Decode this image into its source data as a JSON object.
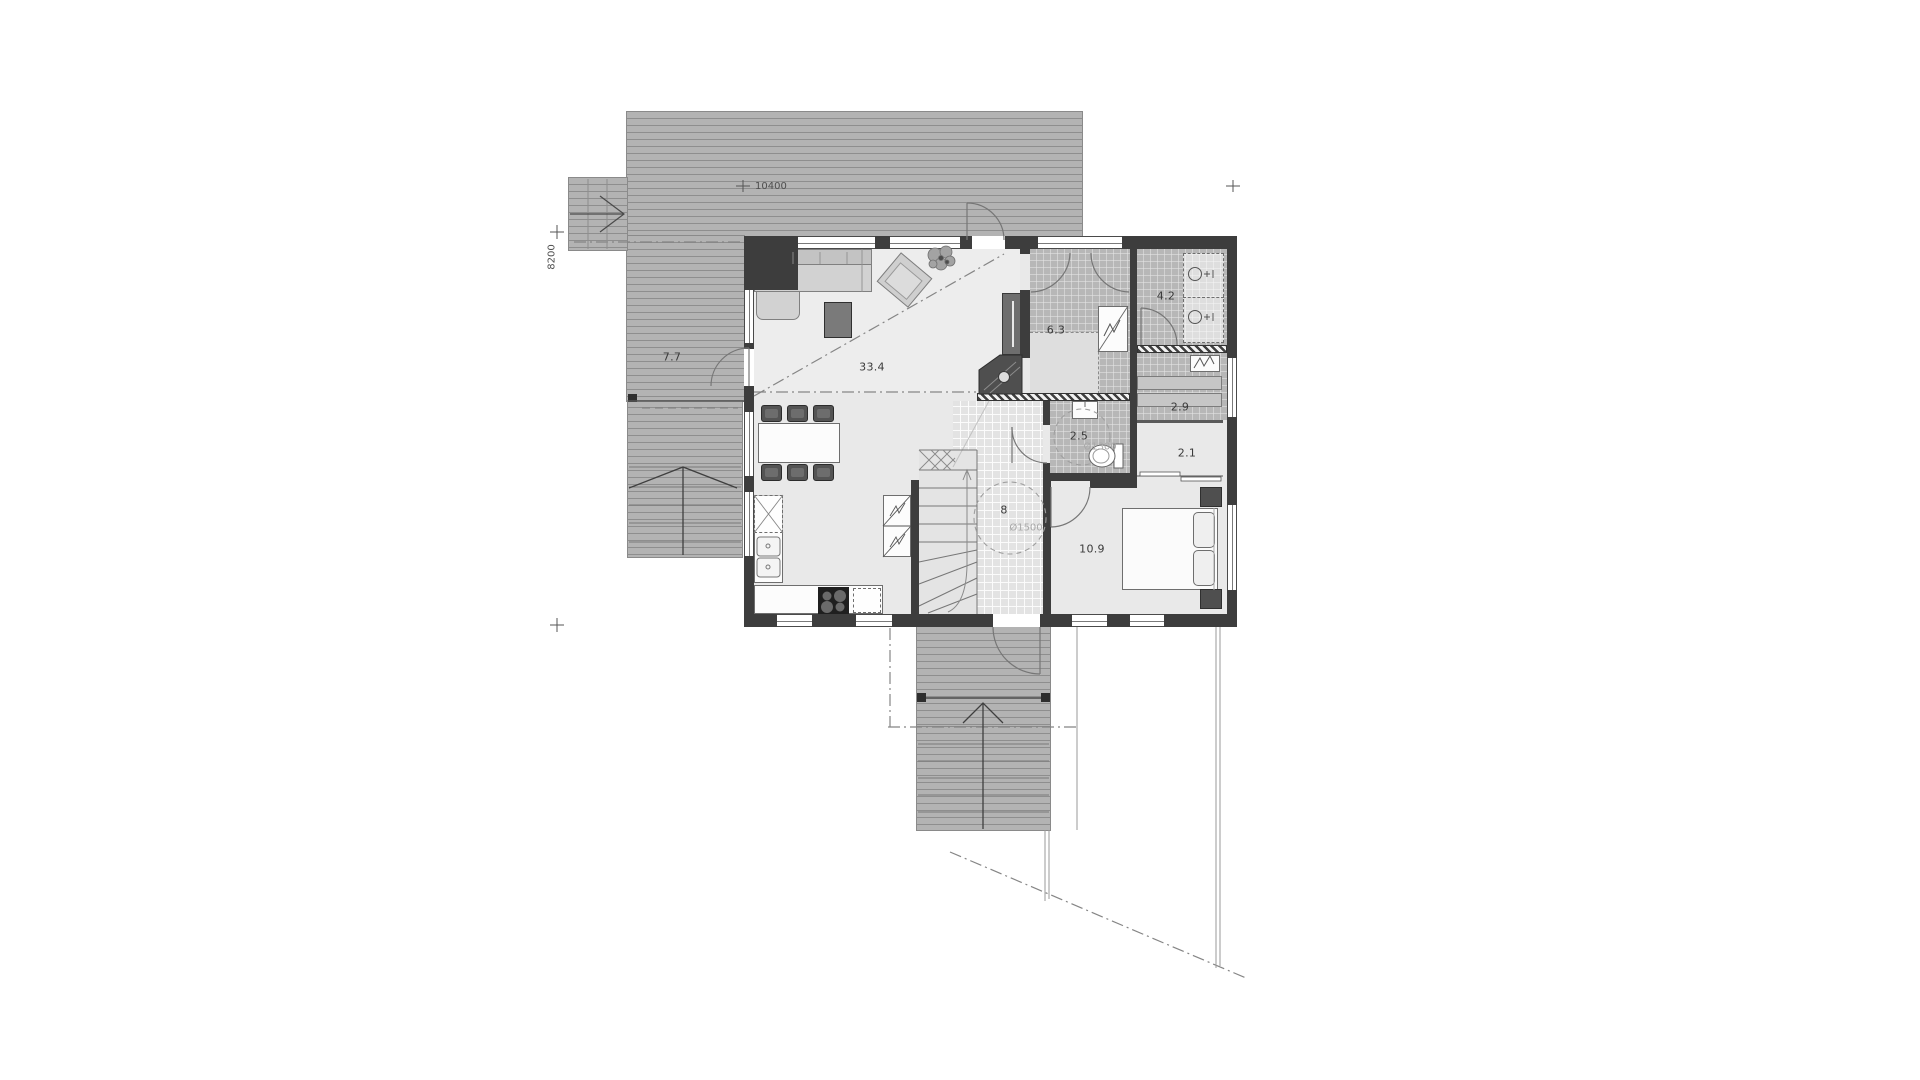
{
  "plan_title": "floor-plan",
  "dimensions": {
    "top": "10400",
    "left": "8200"
  },
  "rooms": {
    "terrace": {
      "area": "7.7"
    },
    "living": {
      "area": "33.4"
    },
    "bathroom": {
      "area": "6.3"
    },
    "utility": {
      "area": "4.2"
    },
    "techroom": {
      "area": "2.9"
    },
    "wc": {
      "area": "2.5"
    },
    "closet": {
      "area": "2.1"
    },
    "hall": {
      "area": "8"
    },
    "bedroom": {
      "area": "10.9"
    }
  },
  "annotations": {
    "hall_turning_circle": "Ø1500",
    "wc_turning_circle": "Ø1300"
  },
  "colors": {
    "deck": "#b3b3b3",
    "floor": "#e9e9e9",
    "tile": "#b7b7b7",
    "wall": "#3d3d3d",
    "line": "#858585"
  }
}
